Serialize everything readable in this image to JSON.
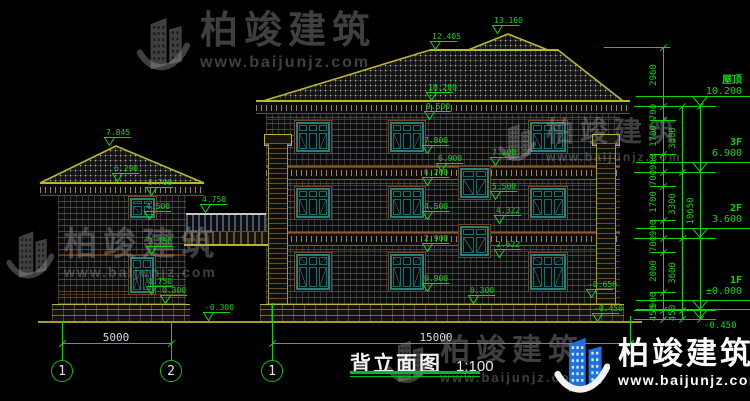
{
  "title": {
    "text": "背立面图",
    "scale": "1:100"
  },
  "watermark": {
    "brand": "柏竣建筑",
    "site": "www.baijunjz.com"
  },
  "logo": {
    "brand": "柏竣建筑",
    "registered": "®",
    "site": "www.baijunjz.com",
    "blue": "#1e6fe0"
  },
  "colors": {
    "annotation_green": "#0ed60e",
    "roof_outline_olive": "#b8b832",
    "window_teal": "#27807d",
    "trim_brown": "#7a421d",
    "logo_blue": "#1e6fe0",
    "dim_text_white": "#d9d9d9",
    "watermark_gray": "#3f3f3f"
  },
  "floor_levels": [
    {
      "name": "屋顶",
      "value": "10.200",
      "y": 106
    },
    {
      "name": "3F",
      "value": "6.900",
      "y": 172
    },
    {
      "name": "2F",
      "value": "3.600",
      "y": 238
    },
    {
      "name": "1F",
      "value": "±0.000",
      "y": 310
    },
    {
      "name": "",
      "value": "-0.450",
      "y": 319,
      "below": true
    }
  ],
  "markers": [
    {
      "t": "13.160",
      "x": 492,
      "y": 34
    },
    {
      "t": "12.405",
      "x": 430,
      "y": 50
    },
    {
      "t": "10.200",
      "x": 426,
      "y": 101
    },
    {
      "t": "9.500",
      "x": 424,
      "y": 120
    },
    {
      "t": "7.800",
      "x": 422,
      "y": 154
    },
    {
      "t": "6.900",
      "x": 436,
      "y": 172
    },
    {
      "t": "6.200",
      "x": 422,
      "y": 186
    },
    {
      "t": "4.500",
      "x": 422,
      "y": 220
    },
    {
      "t": "2.900",
      "x": 422,
      "y": 252
    },
    {
      "t": "0.900",
      "x": 422,
      "y": 292
    },
    {
      "t": "0.300",
      "x": 468,
      "y": 304
    },
    {
      "t": "7.200",
      "x": 490,
      "y": 166
    },
    {
      "t": "5.500",
      "x": 490,
      "y": 200
    },
    {
      "t": "4.322",
      "x": 494,
      "y": 224
    },
    {
      "t": "2.622",
      "x": 494,
      "y": 258
    },
    {
      "t": "-0.650",
      "x": 586,
      "y": 298
    },
    {
      "t": "-0.450",
      "x": 592,
      "y": 322
    },
    {
      "t": "7.845",
      "x": 104,
      "y": 146
    },
    {
      "t": "6.290",
      "x": 112,
      "y": 182
    },
    {
      "t": "5.700",
      "x": 146,
      "y": 196
    },
    {
      "t": "4.500",
      "x": 144,
      "y": 220
    },
    {
      "t": "2.750",
      "x": 146,
      "y": 255
    },
    {
      "t": "0.750",
      "x": 146,
      "y": 295
    },
    {
      "t": "0.300",
      "x": 160,
      "y": 304
    },
    {
      "t": "-0.300",
      "x": 203,
      "y": 321
    },
    {
      "t": "4.750",
      "x": 200,
      "y": 213
    }
  ],
  "chains": [
    {
      "x": 663,
      "y1": 47,
      "y2": 319,
      "ticks": [
        47,
        106,
        120,
        154,
        172,
        186,
        220,
        238,
        252,
        292,
        310,
        319
      ],
      "segs": [
        {
          "v": "2960",
          "y": 76
        },
        {
          "v": "700",
          "y": 113
        },
        {
          "v": "1700",
          "y": 137
        },
        {
          "v": "900",
          "y": 163
        },
        {
          "v": "700",
          "y": 179
        },
        {
          "v": "1700",
          "y": 203
        },
        {
          "v": "900",
          "y": 229
        },
        {
          "v": "700",
          "y": 245
        },
        {
          "v": "2000",
          "y": 272
        },
        {
          "v": "900",
          "y": 301
        },
        {
          "v": "450",
          "y": 314
        }
      ]
    },
    {
      "x": 682,
      "y1": 106,
      "y2": 319,
      "ticks": [
        106,
        172,
        238,
        310,
        319
      ],
      "segs": [
        {
          "v": "3300",
          "y": 139
        },
        {
          "v": "3300",
          "y": 205
        },
        {
          "v": "3600",
          "y": 274
        },
        {
          "v": "450",
          "y": 314
        }
      ]
    },
    {
      "x": 700,
      "y1": 106,
      "y2": 319,
      "ticks": [
        106,
        319
      ],
      "segs": [
        {
          "v": "10650",
          "y": 212
        }
      ]
    }
  ],
  "hlines": [
    {
      "y": 47,
      "x1": 604,
      "x2": 670
    },
    {
      "y": 106,
      "x1": 634,
      "x2": 716
    },
    {
      "y": 172,
      "x1": 634,
      "x2": 716
    },
    {
      "y": 238,
      "x1": 634,
      "x2": 716
    },
    {
      "y": 310,
      "x1": 634,
      "x2": 716
    },
    {
      "y": 319,
      "x1": 634,
      "x2": 716
    },
    {
      "y": 120,
      "x1": 650,
      "x2": 676
    },
    {
      "y": 154,
      "x1": 650,
      "x2": 676
    },
    {
      "y": 186,
      "x1": 650,
      "x2": 676
    },
    {
      "y": 220,
      "x1": 650,
      "x2": 676
    },
    {
      "y": 252,
      "x1": 650,
      "x2": 676
    },
    {
      "y": 292,
      "x1": 650,
      "x2": 676
    }
  ],
  "vlines": [
    {
      "x": 62,
      "y1": 322,
      "y2": 359
    },
    {
      "x": 171,
      "y1": 322,
      "y2": 359
    },
    {
      "x": 272,
      "y1": 303,
      "y2": 359
    },
    {
      "x": 630,
      "y1": 316,
      "y2": 343
    }
  ],
  "dims_bottom": [
    {
      "v": "5000",
      "x1": 62,
      "x2": 171,
      "y": 343,
      "tx": 116
    },
    {
      "v": "15000",
      "x1": 272,
      "x2": 630,
      "y": 343,
      "tx": 436
    }
  ],
  "axis_bubbles": [
    {
      "n": "1",
      "x": 62
    },
    {
      "n": "2",
      "x": 171
    },
    {
      "n": "1",
      "x": 272
    }
  ],
  "windows": [
    {
      "x": 294,
      "y": 120,
      "w": 38,
      "h": 34,
      "panes": 3,
      "kind": "std"
    },
    {
      "x": 388,
      "y": 120,
      "w": 38,
      "h": 34,
      "panes": 3,
      "kind": "std"
    },
    {
      "x": 528,
      "y": 120,
      "w": 40,
      "h": 34,
      "panes": 3,
      "kind": "std"
    },
    {
      "x": 294,
      "y": 186,
      "w": 38,
      "h": 34,
      "panes": 3,
      "kind": "std"
    },
    {
      "x": 388,
      "y": 186,
      "w": 38,
      "h": 34,
      "panes": 3,
      "kind": "std"
    },
    {
      "x": 528,
      "y": 186,
      "w": 40,
      "h": 34,
      "panes": 3,
      "kind": "std"
    },
    {
      "x": 294,
      "y": 252,
      "w": 38,
      "h": 40,
      "panes": 3,
      "kind": "tall"
    },
    {
      "x": 388,
      "y": 252,
      "w": 38,
      "h": 40,
      "panes": 3,
      "kind": "tall"
    },
    {
      "x": 528,
      "y": 252,
      "w": 40,
      "h": 40,
      "panes": 3,
      "kind": "tall"
    },
    {
      "x": 458,
      "y": 166,
      "w": 33,
      "h": 34,
      "panes": 2,
      "kind": "std"
    },
    {
      "x": 458,
      "y": 224,
      "w": 33,
      "h": 34,
      "panes": 2,
      "kind": "std"
    },
    {
      "x": 128,
      "y": 196,
      "w": 29,
      "h": 24,
      "panes": 2,
      "kind": "std"
    },
    {
      "x": 128,
      "y": 255,
      "w": 28,
      "h": 40,
      "panes": 2,
      "kind": "french"
    }
  ]
}
